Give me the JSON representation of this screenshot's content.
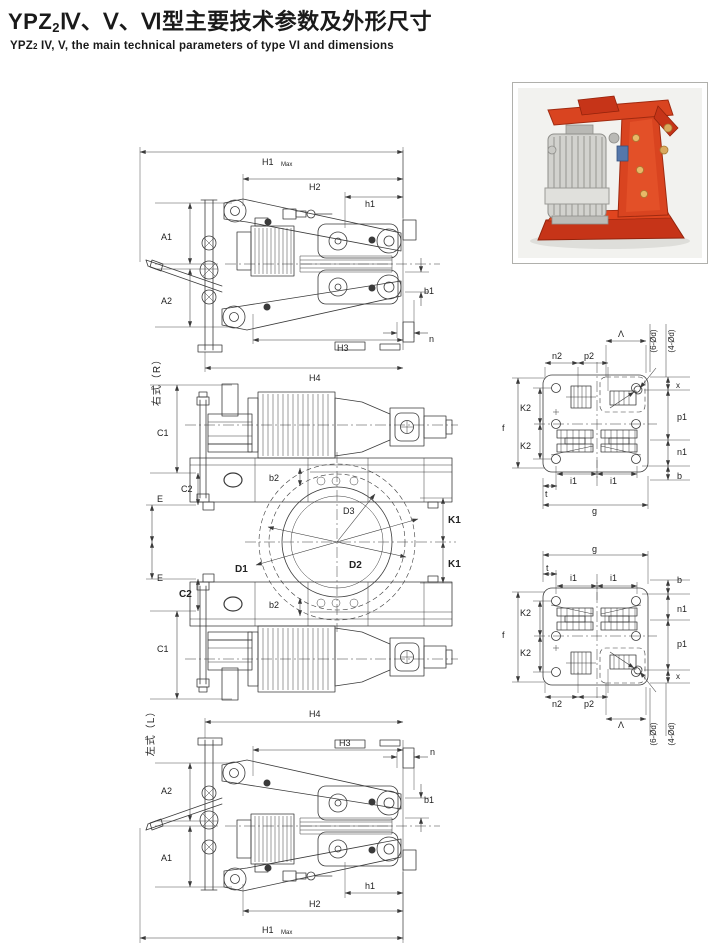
{
  "header": {
    "brand": "YPZ",
    "brand_subscript": "2",
    "title_cn": "Ⅳ、Ⅴ、Ⅵ型主要技术参数及外形尺寸",
    "subtitle_brand": "YPZ",
    "subtitle_subscript": "2",
    "subtitle_en": " IV, V, the main technical parameters of type VI and dimensions"
  },
  "photo": {
    "description": "YPZ2 electro-hydraulic drum brake — red frame with aluminium thruster"
  },
  "views": {
    "side_right": {
      "orientation": "右式（R）"
    },
    "side_left": {
      "orientation": "左式（L）"
    }
  },
  "dim_labels": {
    "H1": "H1",
    "H1_sub": "Max",
    "H2": "H2",
    "h1": "h1",
    "A1": "A1",
    "A2": "A2",
    "H3": "H3",
    "H4": "H4",
    "b1": "b1",
    "n": "n",
    "C1": "C1",
    "C2": "C2",
    "E": "E",
    "b2": "b2",
    "D1": "D1",
    "D2": "D2",
    "D3": "D3",
    "K1": "K1",
    "f": "f",
    "K2": "K2",
    "n2": "n2",
    "p2": "p2",
    "lambda": "Λ",
    "x": "x",
    "p1": "p1",
    "n1": "n1",
    "b": "b",
    "i1": "i1",
    "t": "t",
    "g": "g",
    "holes_6": "(6-Ød)",
    "holes_4": "(4-Ød)"
  },
  "colors": {
    "line": "#3a3a3a",
    "brake_red": "#d8441f",
    "brake_red_dark": "#a02a10",
    "thruster_silver": "#d2d2ce",
    "photo_bg": "#f2f2ef"
  }
}
